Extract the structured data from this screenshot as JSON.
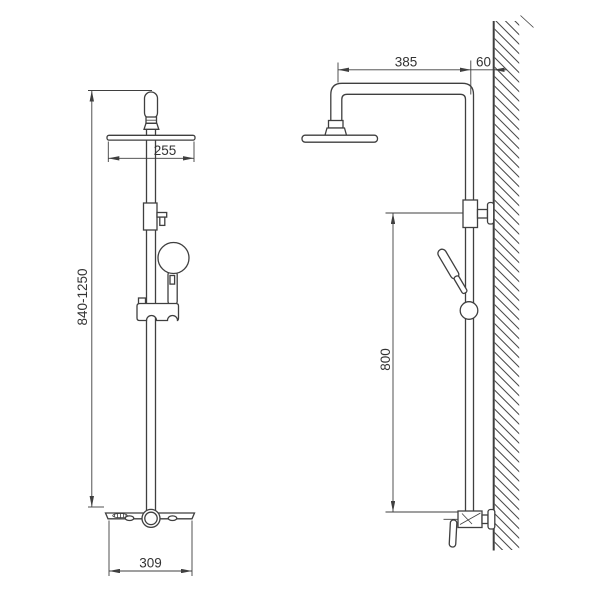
{
  "drawing": {
    "colors": {
      "line": "#3f3f3f",
      "text": "#333333",
      "hatch": "#4a4a4a",
      "background": "#ffffff"
    },
    "views": {
      "front": {
        "labels": {
          "head_width": "255",
          "height_range": "840-1250",
          "base_width": "309"
        }
      },
      "side": {
        "labels": {
          "arm_reach": "385",
          "wall_offset": "60",
          "riser_height": "800"
        }
      }
    }
  }
}
